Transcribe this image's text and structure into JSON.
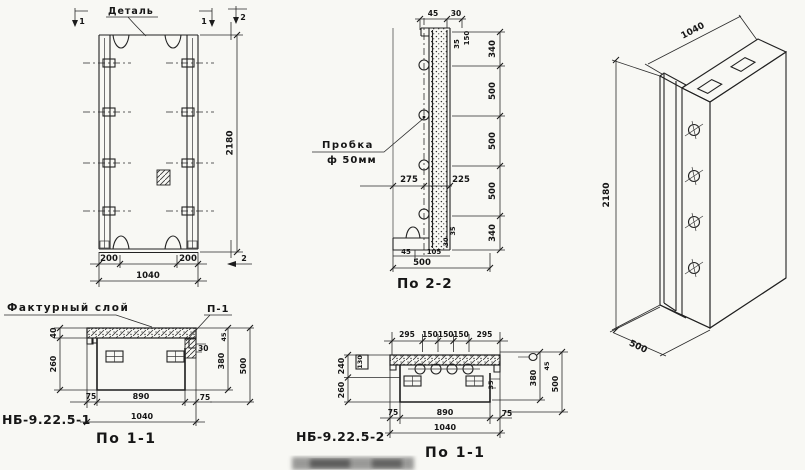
{
  "front_view": {
    "detail_label": "Деталь",
    "marker_1_left": "1",
    "marker_1_right": "1",
    "marker_2_top": "2",
    "marker_2_bottom": "2",
    "dim_height": "2180",
    "dim_left": "200",
    "dim_right": "200",
    "dim_width": "1040"
  },
  "section_2_2": {
    "caption": "По 2-2",
    "plug_label": "Пробка",
    "plug_dia": "ф 50мм",
    "dim_top_1": "45",
    "dim_top_2": "30",
    "dim_top_3": "35",
    "dim_top_4": "150",
    "dims_vertical": [
      "340",
      "500",
      "500",
      "500",
      "340"
    ],
    "dim_mid_left": "275",
    "dim_mid_right": "225",
    "dim_bot_1": "45",
    "dim_bot_2": "105",
    "dim_bot_3": "30",
    "dim_bot_4": "35",
    "dim_width": "500"
  },
  "isometric": {
    "dim_width": "1040",
    "dim_height": "2180",
    "dim_depth": "500"
  },
  "section_1_1_a": {
    "texture_label": "Фактурный слой",
    "joint_label": "П-1",
    "dim_facing": "40",
    "dim_body": "260",
    "dim_30": "30",
    "dim_45": "45",
    "dim_380": "380",
    "dim_500": "500",
    "dim_75l": "75",
    "dim_890": "890",
    "dim_75r": "75",
    "dim_1040": "1040",
    "mark": "НБ-9.22.5-1",
    "caption": "По 1-1"
  },
  "section_1_1_b": {
    "dims_top": [
      "295",
      "150",
      "150",
      "150",
      "295"
    ],
    "dim_240": "240",
    "dim_260": "260",
    "dim_130": "130",
    "dim_30": "30",
    "dim_35": "35",
    "dim_45": "45",
    "dim_380": "380",
    "dim_500": "500",
    "dim_75l": "75",
    "dim_890": "890",
    "dim_75r": "75",
    "dim_1040": "1040",
    "mark": "НБ-9.22.5-2",
    "caption": "По 1-1"
  }
}
